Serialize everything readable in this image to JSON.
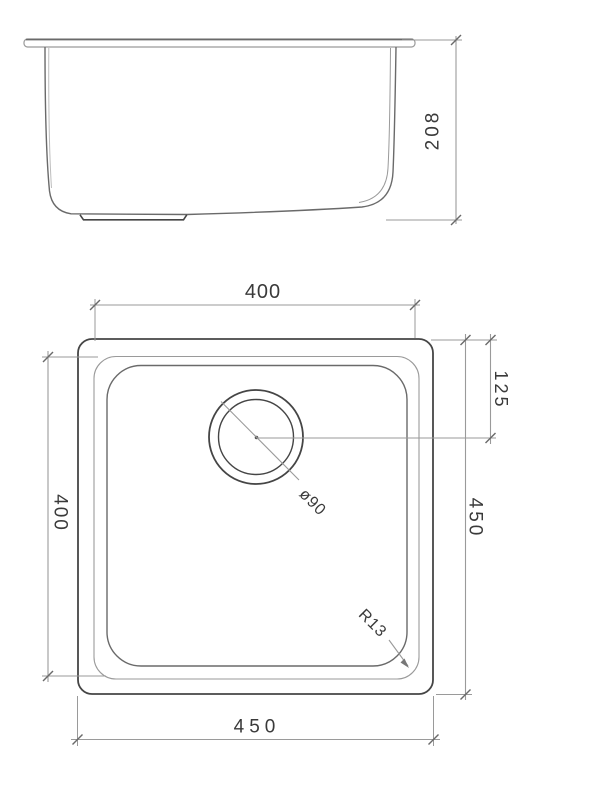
{
  "side_view": {
    "depth_label": "208"
  },
  "plan_view": {
    "bowl_width_label": "400",
    "bowl_length_label": "400",
    "overall_length_label": "450",
    "overall_width_label": "450",
    "drain_offset_label": "125",
    "drain_diameter_label": "ø90",
    "corner_radius_label": "R13"
  },
  "colors": {
    "outline_dark": "#454545",
    "outline_medium": "#6a6a6a",
    "dimension_line": "#9a9a9a",
    "text": "#3a3a3a",
    "background": "#ffffff"
  }
}
